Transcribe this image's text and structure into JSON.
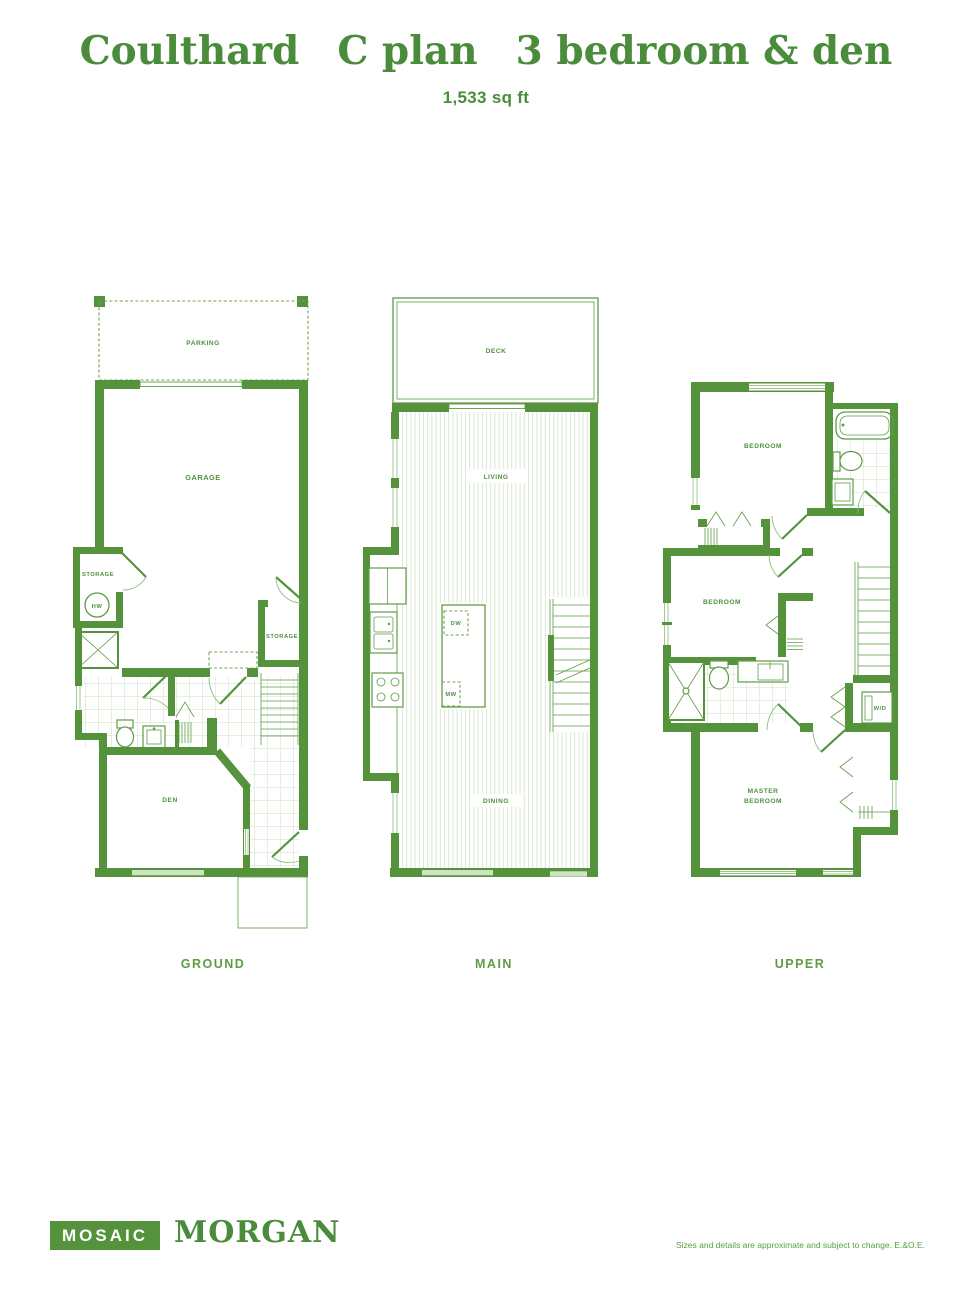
{
  "header": {
    "title_name": "Coulthard",
    "title_plan": "C plan",
    "title_type": "3 bedroom & den",
    "sqft": "1,533 sq ft"
  },
  "floors": {
    "ground": {
      "label": "GROUND",
      "parking": "PARKING",
      "garage": "GARAGE",
      "storage_left": "STORAGE",
      "storage_right": "STORAGE",
      "den": "DEN",
      "hot_water": "HW"
    },
    "main": {
      "label": "MAIN",
      "deck": "DECK",
      "living": "LIVING",
      "dining": "DINING",
      "dishwasher": "DW",
      "microwave": "MW"
    },
    "upper": {
      "label": "UPPER",
      "bedroom_top": "BEDROOM",
      "bedroom_mid": "BEDROOM",
      "master_line1": "MASTER",
      "master_line2": "BEDROOM",
      "washer_dryer": "W/D"
    }
  },
  "footer": {
    "brand": "MOSAIC",
    "project": "MORGAN",
    "disclaimer": "Sizes and details are approximate and subject to change. E.&O.E."
  },
  "colors": {
    "wall_green": "#55923C",
    "line_green": "#5E9C45",
    "light_green": "#8FBD7A",
    "tile_green": "#CCDFC2",
    "stripe_green": "#D9E7D2",
    "title_green": "#4A8C3B",
    "label_green": "#4F9140"
  }
}
